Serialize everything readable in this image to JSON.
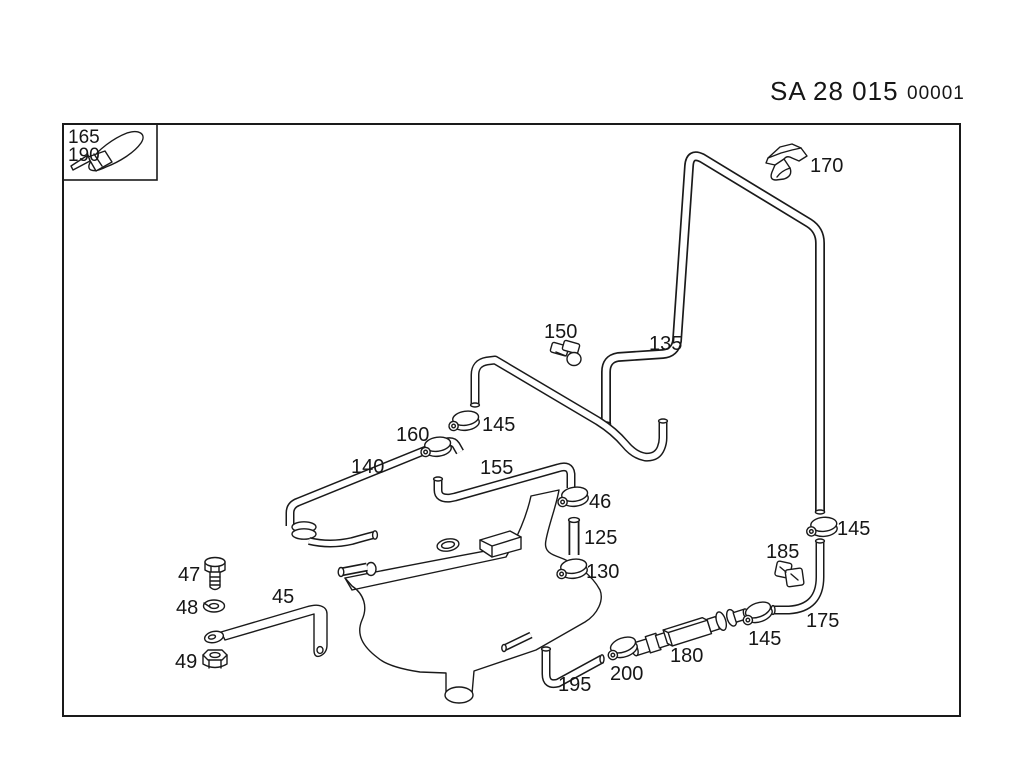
{
  "colors": {
    "paper": "#ffffff",
    "line": "#1a1a1a"
  },
  "header": {
    "series": "SA",
    "code": "28 015",
    "sheet": "00001"
  },
  "inset": {
    "labels": [
      {
        "text": "165"
      },
      {
        "text": "190"
      }
    ],
    "part_icon": "cable-tie-icon"
  },
  "callouts": [
    {
      "text": "170"
    },
    {
      "text": "150"
    },
    {
      "text": "135"
    },
    {
      "text": "145"
    },
    {
      "text": "160"
    },
    {
      "text": "140"
    },
    {
      "text": "155"
    },
    {
      "text": "46"
    },
    {
      "text": "125"
    },
    {
      "text": "130"
    },
    {
      "text": "47"
    },
    {
      "text": "48"
    },
    {
      "text": "45"
    },
    {
      "text": "49"
    },
    {
      "text": "185"
    },
    {
      "text": "145"
    },
    {
      "text": "175"
    },
    {
      "text": "145"
    },
    {
      "text": "180"
    },
    {
      "text": "200"
    },
    {
      "text": "195"
    }
  ]
}
